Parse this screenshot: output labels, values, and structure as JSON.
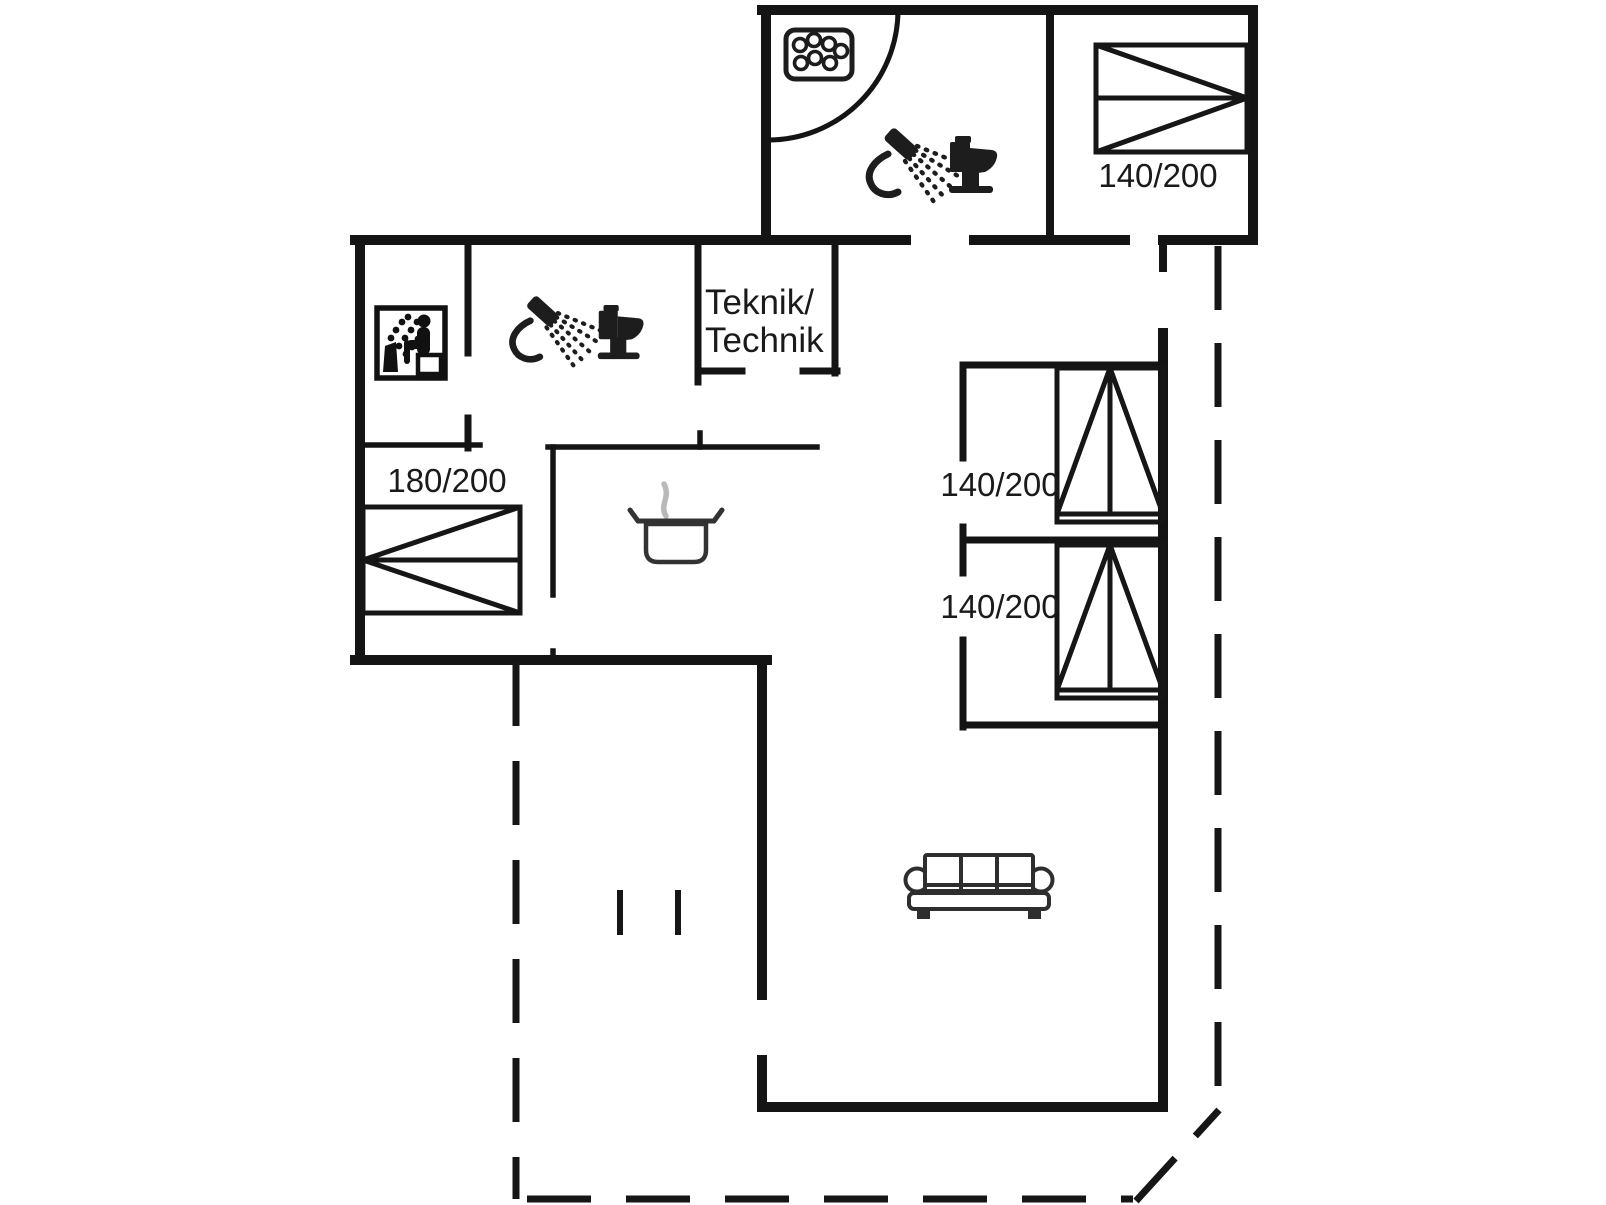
{
  "title": "Holiday home floor plan",
  "colors": {
    "background": "#ffffff",
    "walls": "#141414",
    "furniture_line": "#1d1d1d",
    "steam": "#b9b9b9",
    "text": "#1a1a1a"
  },
  "rooms": {
    "technical_room": {
      "label_line1": "Teknik/",
      "label_line2": "Technik"
    }
  },
  "beds": [
    {
      "id": "bed-top-right",
      "size_label": "140/200"
    },
    {
      "id": "bed-left",
      "size_label": "180/200"
    },
    {
      "id": "bed-right-upper",
      "size_label": "140/200"
    },
    {
      "id": "bed-right-lower",
      "size_label": "140/200"
    }
  ],
  "icons": [
    "whirlpool-icon",
    "shower-icon",
    "toilet-icon",
    "sauna-icon",
    "cooking-pot-icon",
    "sofa-icon",
    "door-swing-arc",
    "terrace-boundary-dashed"
  ]
}
